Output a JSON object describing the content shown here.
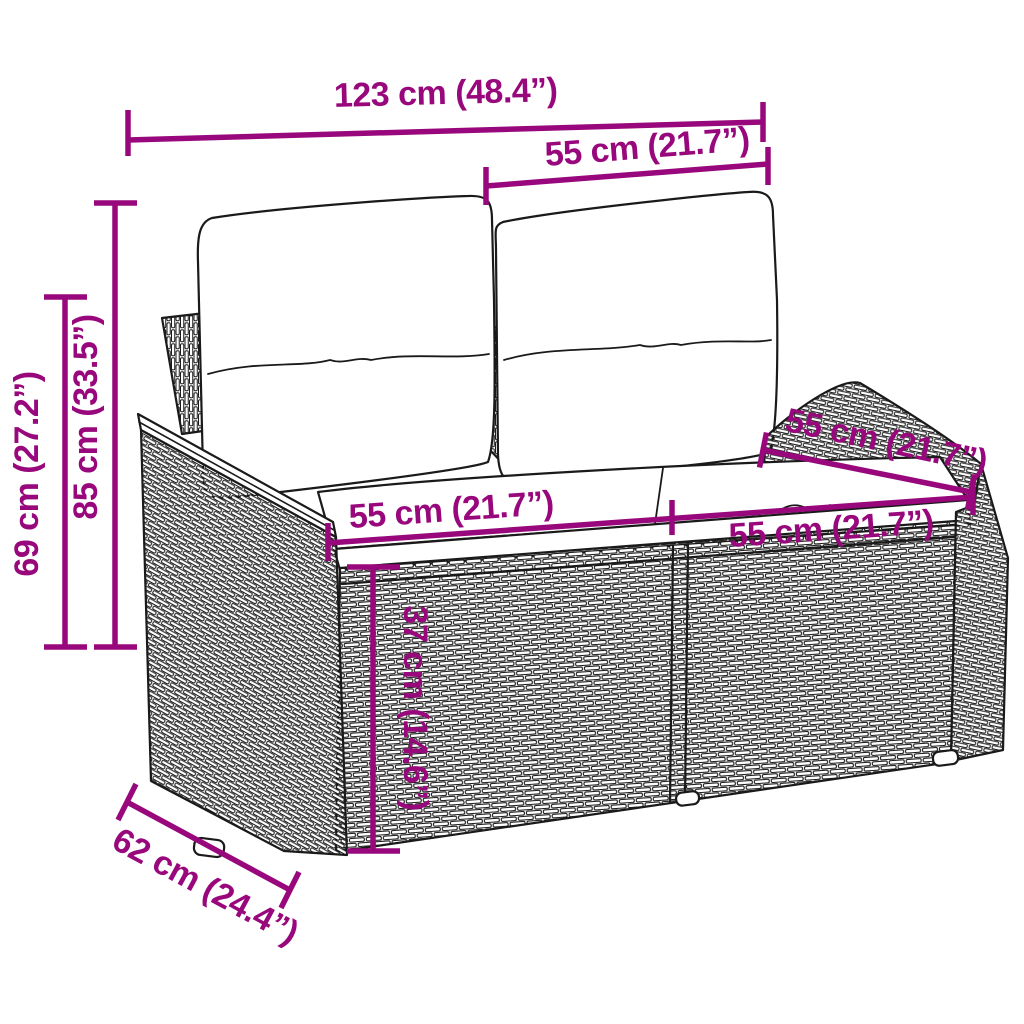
{
  "diagram": {
    "kind": "product-dimension-diagram",
    "subject": "rattan garden loveseat with cushions"
  },
  "colors": {
    "dimension_accent": "#98087C",
    "line_art": "#1a1a1a",
    "background": "#ffffff"
  },
  "dims": {
    "overall_width": "123 cm (48.4”)",
    "backrest_width": "55 cm (21.7”)",
    "total_height": "85 cm (33.5”)",
    "armrest_height": "69 cm (27.2”)",
    "seat_width_left": "55 cm (21.7”)",
    "seat_width_right": "55 cm (21.7”)",
    "seat_depth": "55 cm (21.7”)",
    "seat_height": "37 cm (14.6”)",
    "base_depth": "62 cm (24.4”)"
  }
}
